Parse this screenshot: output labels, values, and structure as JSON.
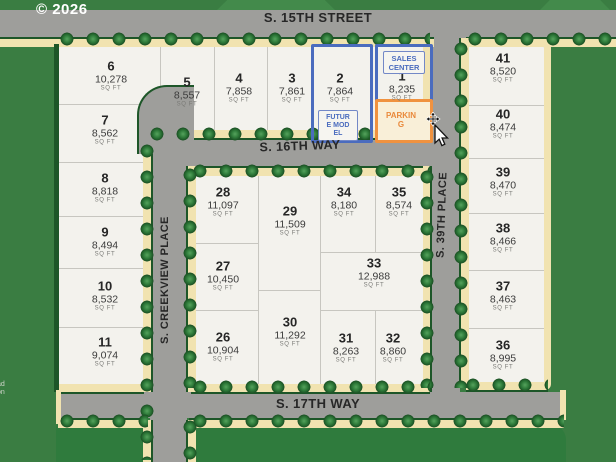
{
  "meta": {
    "copyright": "© 2026"
  },
  "streets": {
    "s15th": "S. 15TH STREET",
    "s16th": "S. 16TH WAY",
    "s17th": "S. 17TH WAY",
    "creekview": "S. CREEKVIEW PLACE",
    "s39th": "S. 39TH PLACE"
  },
  "labels": {
    "sqft_unit": "SQ FT",
    "sales_center": {
      "lines": [
        "SALES",
        "CENTER"
      ]
    },
    "future_model": {
      "lines": [
        "FUTUR",
        "E MOD",
        "EL"
      ]
    },
    "parking": {
      "lines": [
        "PARKIN",
        "G"
      ]
    },
    "edge_note": {
      "lines": [
        "ad",
        "on"
      ]
    }
  },
  "colors": {
    "background_green": "#3a7d42",
    "block_green": "#2f7b3d",
    "street_gray": "#9e9e9b",
    "sidewalk_cream": "#f1e3b0",
    "curb_green": "#1d5628",
    "lot_white": "#f3f2ed",
    "highlight_blue": "#4b6cbe",
    "highlight_orange": "#f0923f"
  },
  "lots": [
    {
      "number": "6",
      "sqft": "10,278",
      "cx": 111,
      "cy": 76
    },
    {
      "number": "5",
      "sqft": "8,557",
      "cx": 187,
      "cy": 92
    },
    {
      "number": "4",
      "sqft": "7,858",
      "cx": 239,
      "cy": 88
    },
    {
      "number": "3",
      "sqft": "7,861",
      "cx": 292,
      "cy": 88
    },
    {
      "number": "2",
      "sqft": "7,864",
      "cx": 340,
      "cy": 88,
      "highlight": "blue"
    },
    {
      "number": "1",
      "sqft": "8,235",
      "cx": 402,
      "cy": 86,
      "highlight": "blue"
    },
    {
      "number": "7",
      "sqft": "8,562",
      "cx": 105,
      "cy": 130
    },
    {
      "number": "8",
      "sqft": "8,818",
      "cx": 105,
      "cy": 188
    },
    {
      "number": "9",
      "sqft": "8,494",
      "cx": 105,
      "cy": 242
    },
    {
      "number": "10",
      "sqft": "8,532",
      "cx": 105,
      "cy": 296
    },
    {
      "number": "11",
      "sqft": "9,074",
      "cx": 105,
      "cy": 352
    },
    {
      "number": "28",
      "sqft": "11,097",
      "cx": 223,
      "cy": 202
    },
    {
      "number": "29",
      "sqft": "11,509",
      "cx": 290,
      "cy": 221
    },
    {
      "number": "27",
      "sqft": "10,450",
      "cx": 223,
      "cy": 276
    },
    {
      "number": "26",
      "sqft": "10,904",
      "cx": 223,
      "cy": 347
    },
    {
      "number": "30",
      "sqft": "11,292",
      "cx": 290,
      "cy": 332
    },
    {
      "number": "34",
      "sqft": "8,180",
      "cx": 344,
      "cy": 202
    },
    {
      "number": "35",
      "sqft": "8,574",
      "cx": 399,
      "cy": 202
    },
    {
      "number": "33",
      "sqft": "12,988",
      "cx": 374,
      "cy": 273
    },
    {
      "number": "31",
      "sqft": "8,263",
      "cx": 346,
      "cy": 348
    },
    {
      "number": "32",
      "sqft": "8,860",
      "cx": 393,
      "cy": 348
    },
    {
      "number": "41",
      "sqft": "8,520",
      "cx": 503,
      "cy": 68
    },
    {
      "number": "40",
      "sqft": "8,474",
      "cx": 503,
      "cy": 124
    },
    {
      "number": "39",
      "sqft": "8,470",
      "cx": 503,
      "cy": 182
    },
    {
      "number": "38",
      "sqft": "8,466",
      "cx": 503,
      "cy": 238
    },
    {
      "number": "37",
      "sqft": "8,463",
      "cx": 503,
      "cy": 296
    },
    {
      "number": "36",
      "sqft": "8,995",
      "cx": 503,
      "cy": 355
    }
  ]
}
